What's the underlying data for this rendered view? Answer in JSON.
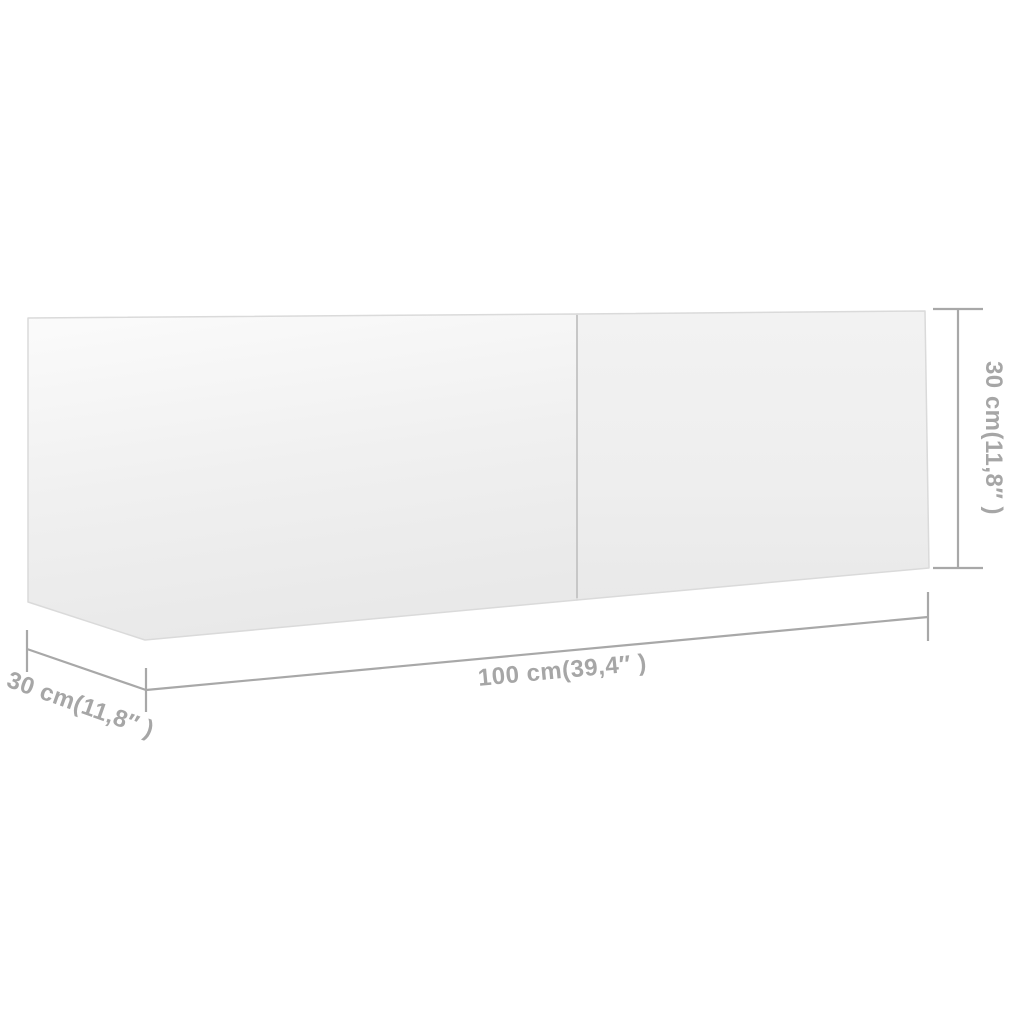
{
  "diagram": {
    "kind": "product-dimension-diagram",
    "subject": "tv-cabinet-two-door-panels",
    "background_color": "#ffffff",
    "labels": {
      "width": "100 cm(39,4″ )",
      "height": "30 cm(11,8″ )",
      "depth": "30 cm(11,8″ )"
    },
    "colors": {
      "dimension_line": "#a8a8a8",
      "dimension_text": "#a6a6a6",
      "cabinet_edge": "#dadada",
      "cabinet_divider": "#c7c7c7",
      "cabinet_face_light": "#fbfbfb",
      "cabinet_face_shade": "#e9e9e9"
    }
  }
}
